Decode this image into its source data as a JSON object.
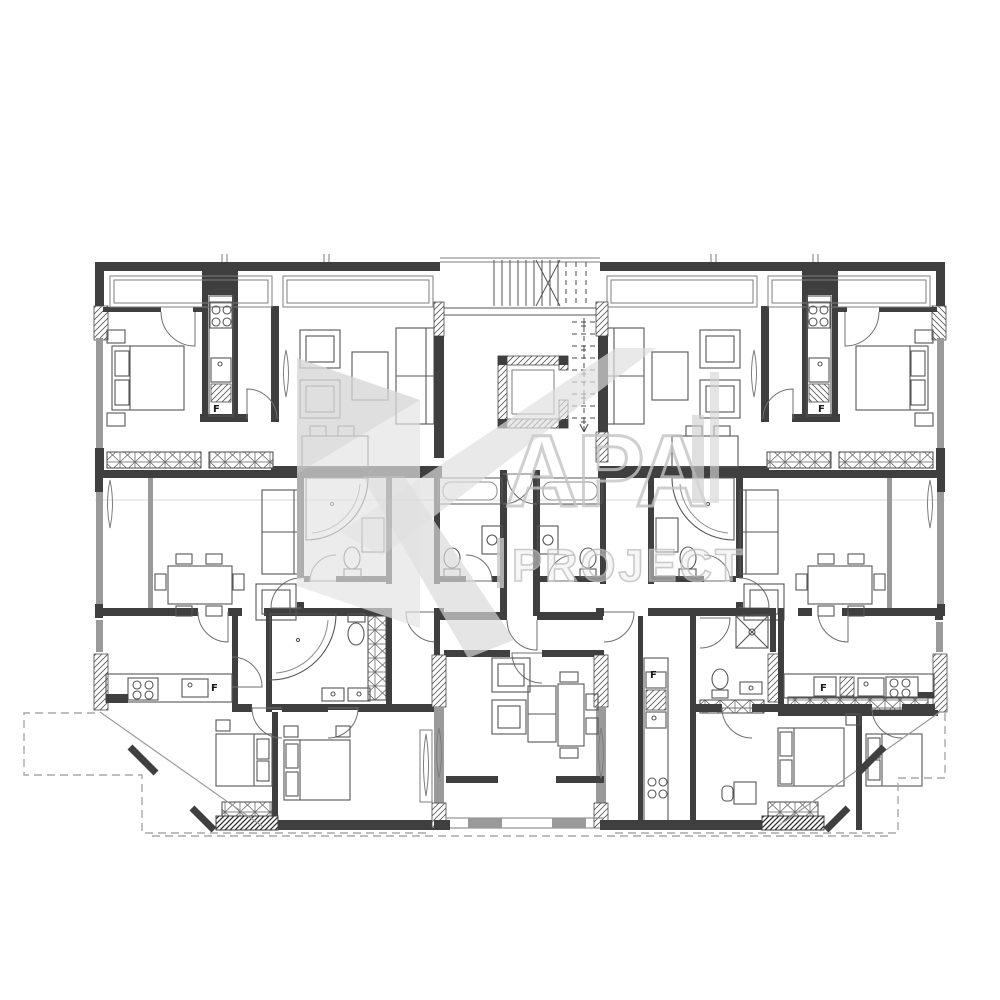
{
  "drawing": {
    "kind": "residential-floor-plan",
    "watermark": {
      "logo_text": "APA",
      "project_text": "PROJECT"
    },
    "labels": {
      "fridge": "F"
    },
    "palette": {
      "background": "#ffffff",
      "wall_dark": "#3f3f3f",
      "wall_medium": "#6e6e6e",
      "wall_window_gray": "#9a9a9a",
      "furniture_line": "#565656",
      "watermark_gray": "#c6c6c6"
    }
  }
}
